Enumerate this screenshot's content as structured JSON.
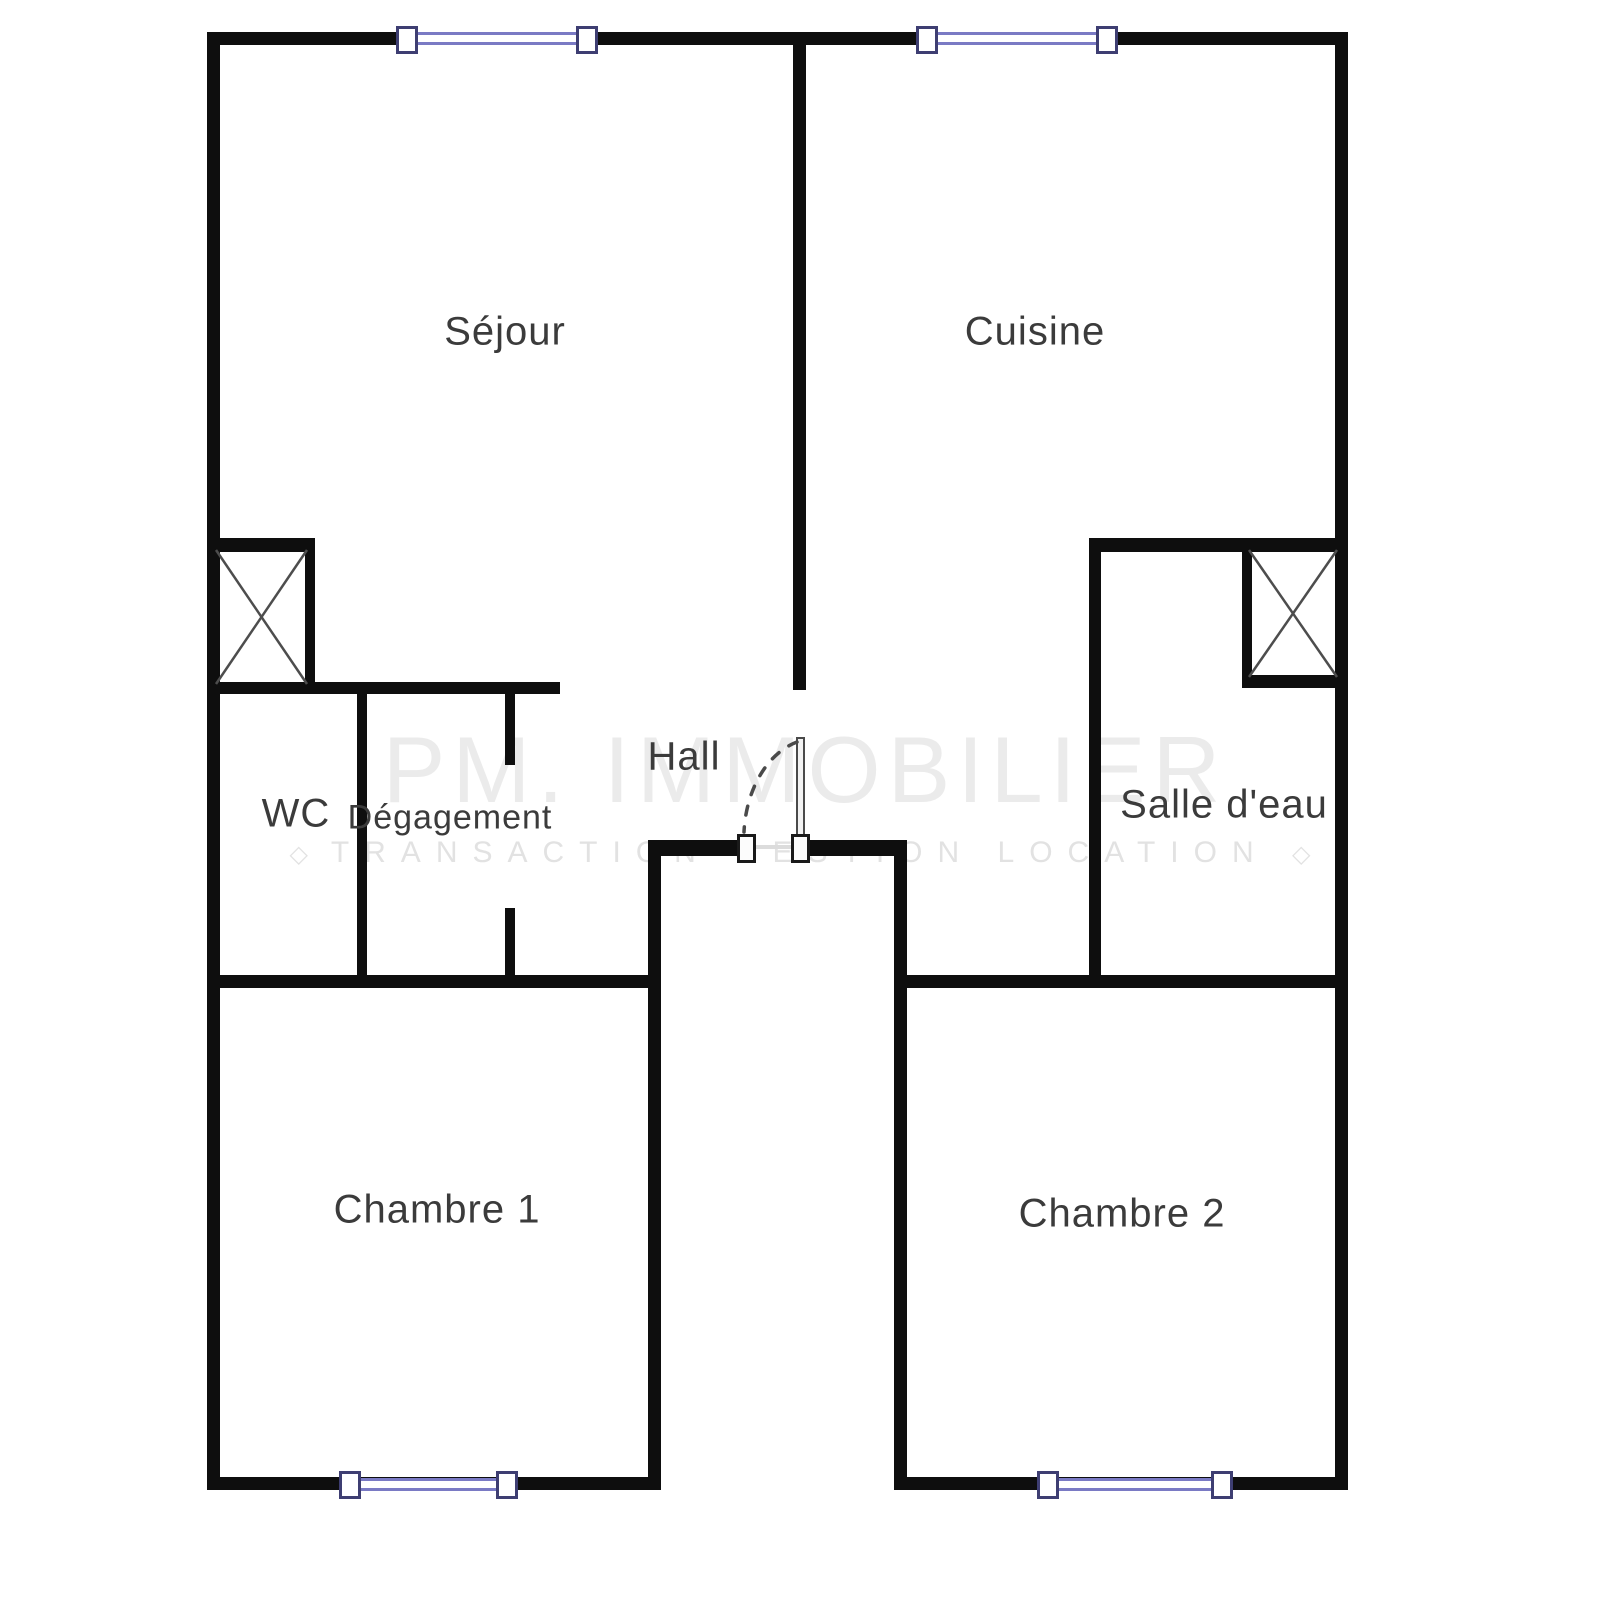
{
  "floorplan": {
    "rooms": {
      "sejour": {
        "label": "Séjour"
      },
      "cuisine": {
        "label": "Cuisine"
      },
      "wc": {
        "label": "WC"
      },
      "degagement": {
        "label": "Dégagement"
      },
      "hall": {
        "label": "Hall"
      },
      "salle_deau": {
        "label": "Salle d'eau"
      },
      "chambre1": {
        "label": "Chambre 1"
      },
      "chambre2": {
        "label": "Chambre 2"
      }
    },
    "watermark": {
      "brand": "PM. IMMOBILIER",
      "tagline": "TRANSACTION GESTION LOCATION",
      "tagline_mark": "◇"
    },
    "colors": {
      "wall": "#0e0e0e",
      "window_glass": "#7a7ac4",
      "window_cap_border": "#3e3e72",
      "label_text": "#3b3b3b",
      "watermark_text": "#e8e8e8",
      "shaft_diagonals": "#4d4d4d"
    }
  }
}
